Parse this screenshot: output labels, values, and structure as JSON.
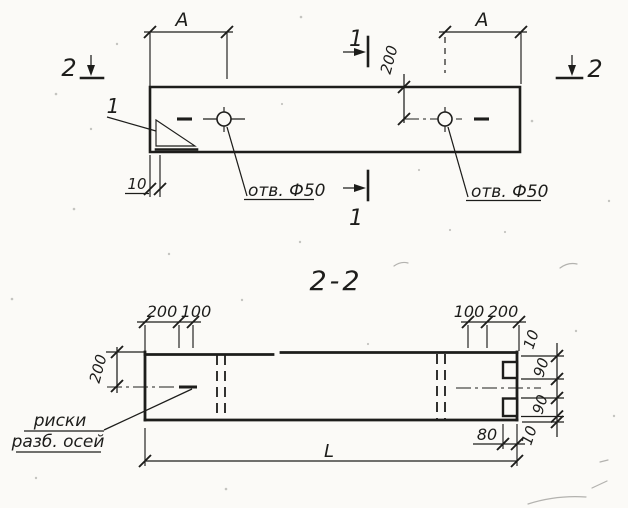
{
  "meta": {
    "ink_color": "#1d1d1b",
    "paper_color": "#fbfaf7"
  },
  "plan_view": {
    "section_cut_top": "1",
    "section_cut_bottom": "1",
    "section_cut_left": "2",
    "section_cut_right": "2",
    "detail_callout": "1",
    "dim_A_left": "A",
    "dim_A_right": "A",
    "dim_hole_offset": "200",
    "dim_edge": "10",
    "hole_label_left": "отв. Ф50",
    "hole_label_right": "отв. Ф50"
  },
  "section_view": {
    "title": "2-2",
    "dims_top_left": [
      "200",
      "100"
    ],
    "dims_top_right": [
      "100",
      "200"
    ],
    "dim_side": "200",
    "dims_right": [
      "10",
      "90",
      "90",
      "10"
    ],
    "dim_notch": "80",
    "dim_length": "L",
    "axis_note": [
      "риски",
      "разб. осей"
    ]
  }
}
